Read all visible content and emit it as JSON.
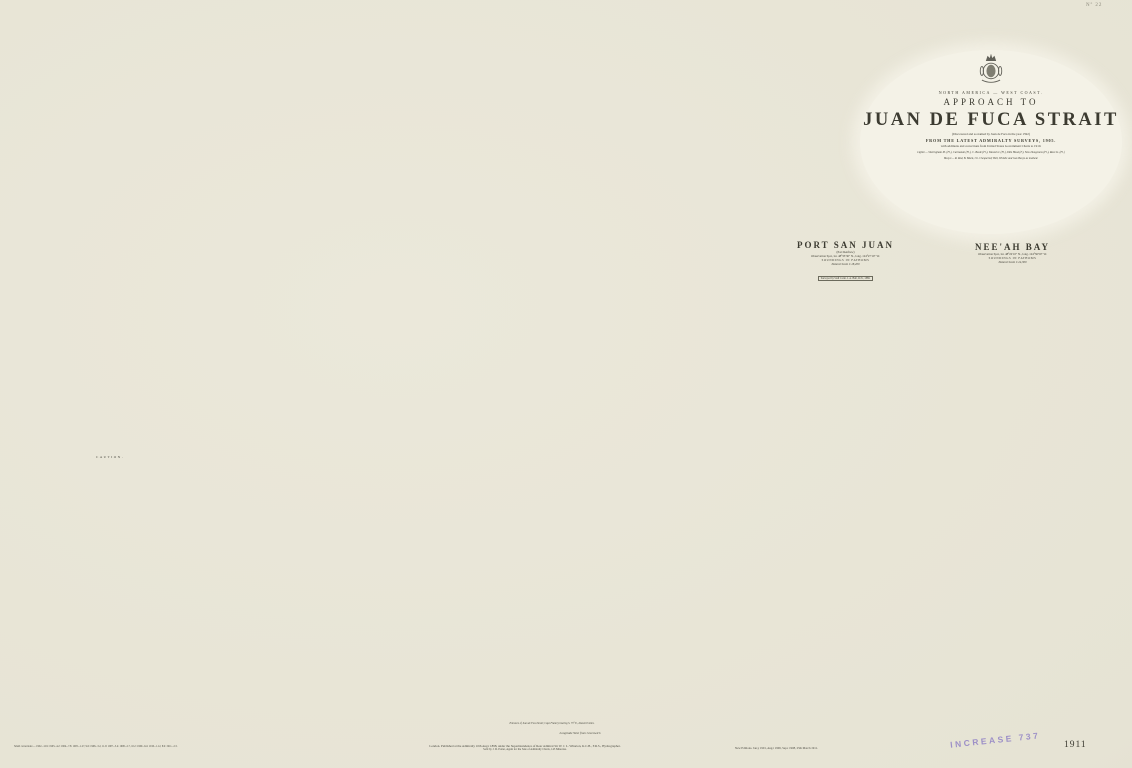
{
  "colors": {
    "paper": "#e8e5d7",
    "sea_white": "#f2f0e4",
    "land_tint": "#d7d5c5",
    "terrain_dark": "#4c4b41",
    "ink": "#3c3b31",
    "lighthouse_gold": "#d7a73b",
    "stamp_purple": "#8b7cc4"
  },
  "frame": {
    "corner_number": "Nº 22",
    "plate_number": "1911",
    "stamp": "INCREASE 737",
    "longitude_label": "Longitude West from Greenwich",
    "meridians": [
      {
        "x": 147,
        "label": "125°"
      },
      {
        "x": 452,
        "label": "124°"
      },
      {
        "x": 757,
        "label": "123°"
      },
      {
        "x": 1062,
        "label": "122°"
      }
    ],
    "parallels": [
      {
        "y": 222,
        "label": "49°"
      },
      {
        "y": 462,
        "label": "48°40′"
      },
      {
        "y": 702,
        "label": "48°20′"
      }
    ]
  },
  "cartouche": {
    "region": "NORTH AMERICA — WEST COAST.",
    "approach": "APPROACH TO",
    "title": "JUAN DE FUCA STRAIT",
    "bracket": "(Discovered and so named by Juan de Fuca in the year 1592)",
    "from_line": "FROM THE LATEST ADMIRALTY SURVEYS, 1905.",
    "additions": "with additions and corrections from United States Government Charts to 1910.",
    "lights1": "Lights:— Sheringham Pt. (Fl.), Carmanah (Fl.), C. Beale (Fl.), Tatoosh I. (Fl.), Ediz Hook (F.), New Dungeness (Fl.), Race Is. (Fl.)",
    "lights2": "Buoys:— R. Red, B. Black, Ch. Chequered; Bell, Whistle and Gas Buoys as marked.",
    "para": [
      "ABBREVIATIONS. s. sand, m. mud, g. gravel, sh. shells, r. rock, cl. clay, co. coral;",
      "f. fine, c. coarse, h. hard, so. soft, bk. black, w. white, y. yellow.",
      "Heights of the land and of dry banks are expressed in feet.",
      "Patches which uncover at Low Water are shaded darker.",
      "Magnetic Variation in 1911, increasing about 1′ annually.",
      "Bearings are given from Seaward and refer to the True Compass (Mag. within).",
      "SCALE. Natural Scale 1:290,000 (Lat. 48°30′).",
      "ENGRAVED at the HYDROGRAPHIC OFFICE."
    ]
  },
  "tide_table": {
    "title": "Tidal Information",
    "columns": [
      "PLACES",
      "Lat. N.",
      "Long. W.",
      "H.W.F.&C.",
      "Sp. Rise",
      "Np. Rise",
      "REMARKS"
    ],
    "rows": [
      [
        "Port San Juan",
        "48°33′",
        "124°27′",
        "4h 35m",
        "7½ ft",
        "5 ft",
        "Tides irregular"
      ],
      [
        "Neeah Bay",
        "48°22′",
        "124°37′",
        "4h 10m",
        "8 ft",
        "5½ ft",
        "—"
      ],
      [
        "Clallam Bay",
        "48°15′",
        "124°16′",
        "4h 20m",
        "7 ft",
        "5 ft",
        "—"
      ],
      [
        "Port Angeles",
        "48°08′",
        "123°26′",
        "3h 45m",
        "6 ft",
        "4½ ft",
        "—"
      ],
      [
        "New Dungeness",
        "48°11′",
        "123°07′",
        "3h 30m",
        "6½ ft",
        "4 ft",
        "—"
      ],
      [
        "Sooke Inlet",
        "48°22′",
        "123°43′",
        "3h 05m",
        "7 ft",
        "5 ft",
        "—"
      ],
      [
        "Race Islands",
        "48°18′",
        "123°32′",
        "2h 50m",
        "6 ft",
        "4 ft",
        "Streams strong"
      ],
      [
        "Esquimalt",
        "48°26′",
        "123°27′",
        "2h 40m",
        "6 ft",
        "4 ft",
        "—"
      ]
    ],
    "note": "The tides are much affected by the prevailing winds; the above is the mean of observations."
  },
  "stream_table": {
    "title": "Average Direction and Rate of the Tidal Streams",
    "columns": [
      "Locality",
      "Flood",
      "Ebb",
      "Rate"
    ],
    "rows": [
      [
        "Entrance of Strait",
        "E.S.E.",
        "W.N.W.",
        "1–3 kn."
      ],
      [
        "Mid-channel",
        "E. ½ S.",
        "W. ½ N.",
        "1–2 kn."
      ],
      [
        "Off Race Islands",
        "E.N.E.",
        "W.S.W.",
        "2–6 kn."
      ]
    ]
  },
  "insets": {
    "port_san_juan": {
      "title": "PORT SAN JUAN",
      "alt": "(Port Renfrew)",
      "obs": "Observation Spot, lat. 48°33′30″ N., long. 124°27′10″ W.",
      "soundings": "SOUNDINGS IN FATHOMS",
      "scale": "Natural Scale 1:18,200",
      "note": "Surveyed by Staff Comr. J. A. Bull, R.N., 1889.",
      "scalebar": "Cables"
    },
    "neeah_bay": {
      "title": "NEE'AH BAY",
      "obs": "Observation Spot, lat. 48°22′10″ N., long. 124°36′50″ W.",
      "soundings": "SOUNDINGS IN FATHOMS",
      "scale": "Natural Scale 1:24,300",
      "scalebar": "Cables"
    }
  },
  "caution": {
    "title": "CAUTION.",
    "lines": [
      "Mariners are cautioned not to depend",
      "on buoys always maintaining their",
      "exact positions."
    ]
  },
  "profile": {
    "caption": "Entrance of Juan de Fuca Strait; Cape Flattery bearing S. 73° E., distant 8 miles."
  },
  "imprint": {
    "corrections": "Small corrections:— 1902.–12.9: 1903.–4.2: 1904.–7.8: 1905.–1.27, 9.6: 1906.–3.2, 11.9: 1907.–5.4: 1908.–2.7, 10.2: 1909.–6.4: 1910.–1.12, 8.9: 1911.–2.3.",
    "publication": "London. Published at the Admiralty 10th Aug.t 1898, under the Superintendence of Rear Admiral Sir W. J. L. Wharton, K.C.B., F.R.S., Hydrographer.",
    "agent": "Sold by J. D. Potter, Agent for the Sale of Admiralty Charts, 145 Minories.",
    "editions": "New Editions. Jan.y 1901, Aug.t 1906, Sep.t 1908, 25th March 1911."
  },
  "map_labels": {
    "island_upper": "VANCOUVER",
    "island_lower": "ISLAND",
    "strait": "JUAN DE FUCA STRAIT",
    "state": "WASHINGTON",
    "range": "Olympic Range"
  },
  "place_labels": [
    "Barkley Sd.",
    "Nitinat Lake",
    "Carmanah Pt.",
    "Port San Juan",
    "Sooke Inlet",
    "Race Is.",
    "C. Flattery",
    "Neeah Bay",
    "Ediz Hook",
    "New Dungeness",
    "Swiftsure Bank"
  ],
  "soundings": {
    "unit": "fathoms",
    "ocean": [
      27,
      35,
      42,
      48,
      55,
      63,
      70,
      78,
      84,
      92,
      105,
      110,
      118,
      124,
      133,
      141,
      150,
      95,
      87,
      76,
      68,
      57,
      49,
      39,
      31,
      160
    ],
    "strait": [
      15,
      18,
      22,
      27,
      33,
      38,
      44,
      52,
      57,
      63,
      70,
      75,
      82,
      88,
      94,
      48,
      36,
      29,
      24,
      59
    ],
    "inshore": [
      2,
      3,
      4,
      5,
      6,
      7,
      8,
      9,
      10,
      12,
      13,
      15,
      4,
      6,
      8
    ]
  }
}
